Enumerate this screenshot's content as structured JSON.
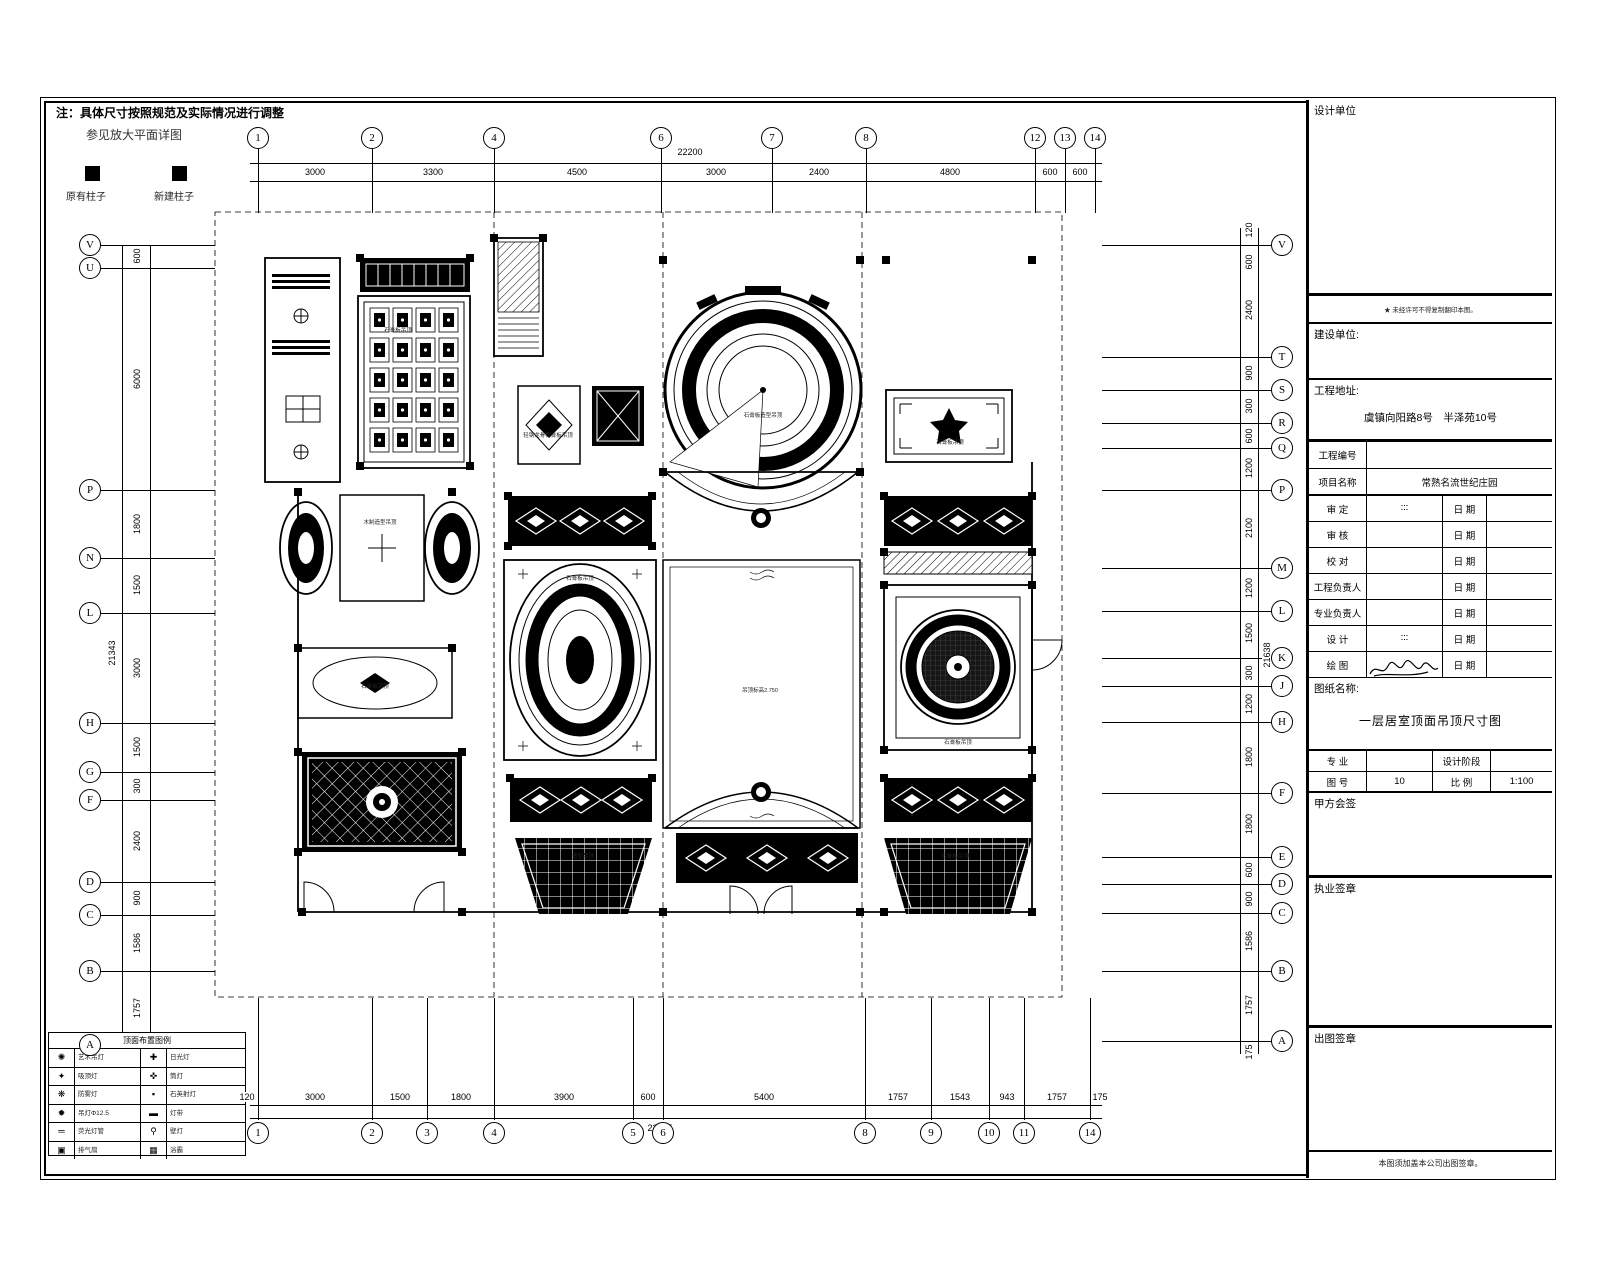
{
  "note": {
    "line1": "注：具体尺寸按照规范及实际情况进行调整",
    "line2": "参见放大平面详图",
    "existing_column": "原有柱子",
    "new_column": "新建柱子"
  },
  "axes": {
    "top": {
      "total": "22200",
      "bubbles": [
        {
          "label": "1",
          "x": 258
        },
        {
          "label": "2",
          "x": 372
        },
        {
          "label": "4",
          "x": 494
        },
        {
          "label": "6",
          "x": 661
        },
        {
          "label": "7",
          "x": 772
        },
        {
          "label": "8",
          "x": 866
        },
        {
          "label": "12",
          "x": 1035
        },
        {
          "label": "13",
          "x": 1065
        },
        {
          "label": "14",
          "x": 1095
        }
      ],
      "segments": [
        {
          "label": "3000",
          "x": 315
        },
        {
          "label": "3300",
          "x": 433
        },
        {
          "label": "4500",
          "x": 577
        },
        {
          "label": "3000",
          "x": 716
        },
        {
          "label": "2400",
          "x": 819
        },
        {
          "label": "4800",
          "x": 950
        },
        {
          "label": "600",
          "x": 1050
        },
        {
          "label": "600",
          "x": 1080
        }
      ]
    },
    "bottom": {
      "total": "22195",
      "bubbles": [
        {
          "label": "1",
          "x": 258
        },
        {
          "label": "2",
          "x": 372
        },
        {
          "label": "3",
          "x": 427
        },
        {
          "label": "4",
          "x": 494
        },
        {
          "label": "5",
          "x": 633
        },
        {
          "label": "6",
          "x": 663
        },
        {
          "label": "8",
          "x": 865
        },
        {
          "label": "9",
          "x": 931
        },
        {
          "label": "10",
          "x": 989
        },
        {
          "label": "11",
          "x": 1024
        },
        {
          "label": "14",
          "x": 1090
        }
      ],
      "segments": [
        {
          "label": "120",
          "x": 247
        },
        {
          "label": "3000",
          "x": 315
        },
        {
          "label": "1500",
          "x": 400
        },
        {
          "label": "1800",
          "x": 461
        },
        {
          "label": "3900",
          "x": 564
        },
        {
          "label": "600",
          "x": 648
        },
        {
          "label": "5400",
          "x": 764
        },
        {
          "label": "1757",
          "x": 898
        },
        {
          "label": "1543",
          "x": 960
        },
        {
          "label": "943",
          "x": 1007
        },
        {
          "label": "1757",
          "x": 1057
        },
        {
          "label": "175",
          "x": 1100
        }
      ]
    },
    "left": {
      "total": "21343",
      "bubbles": [
        {
          "label": "V",
          "y": 245
        },
        {
          "label": "U",
          "y": 268
        },
        {
          "label": "P",
          "y": 490
        },
        {
          "label": "N",
          "y": 558
        },
        {
          "label": "L",
          "y": 613
        },
        {
          "label": "H",
          "y": 723
        },
        {
          "label": "G",
          "y": 772
        },
        {
          "label": "F",
          "y": 800
        },
        {
          "label": "D",
          "y": 882
        },
        {
          "label": "C",
          "y": 915
        },
        {
          "label": "B",
          "y": 971
        },
        {
          "label": "A",
          "y": 1045
        }
      ],
      "segments": [
        {
          "label": "600",
          "y": 256
        },
        {
          "label": "6000",
          "y": 379
        },
        {
          "label": "1800",
          "y": 524
        },
        {
          "label": "1500",
          "y": 585
        },
        {
          "label": "3000",
          "y": 668
        },
        {
          "label": "1500",
          "y": 747
        },
        {
          "label": "300",
          "y": 786
        },
        {
          "label": "2400",
          "y": 841
        },
        {
          "label": "900",
          "y": 898
        },
        {
          "label": "1586",
          "y": 943
        },
        {
          "label": "1757",
          "y": 1008
        }
      ]
    },
    "right": {
      "total": "21638",
      "bubbles": [
        {
          "label": "V",
          "y": 245
        },
        {
          "label": "T",
          "y": 357
        },
        {
          "label": "S",
          "y": 390
        },
        {
          "label": "R",
          "y": 423
        },
        {
          "label": "Q",
          "y": 448
        },
        {
          "label": "P",
          "y": 490
        },
        {
          "label": "M",
          "y": 568
        },
        {
          "label": "L",
          "y": 611
        },
        {
          "label": "K",
          "y": 658
        },
        {
          "label": "J",
          "y": 686
        },
        {
          "label": "H",
          "y": 722
        },
        {
          "label": "F",
          "y": 793
        },
        {
          "label": "E",
          "y": 857
        },
        {
          "label": "D",
          "y": 884
        },
        {
          "label": "C",
          "y": 913
        },
        {
          "label": "B",
          "y": 971
        },
        {
          "label": "A",
          "y": 1041
        }
      ],
      "segments": [
        {
          "label": "120",
          "y": 230
        },
        {
          "label": "600",
          "y": 262
        },
        {
          "label": "2400",
          "y": 310
        },
        {
          "label": "900",
          "y": 373
        },
        {
          "label": "300",
          "y": 406
        },
        {
          "label": "600",
          "y": 436
        },
        {
          "label": "1200",
          "y": 468
        },
        {
          "label": "2100",
          "y": 528
        },
        {
          "label": "1200",
          "y": 588
        },
        {
          "label": "1500",
          "y": 633
        },
        {
          "label": "300",
          "y": 673
        },
        {
          "label": "1200",
          "y": 704
        },
        {
          "label": "1800",
          "y": 757
        },
        {
          "label": "1800",
          "y": 824
        },
        {
          "label": "600",
          "y": 870
        },
        {
          "label": "900",
          "y": 899
        },
        {
          "label": "1586",
          "y": 941
        },
        {
          "label": "1757",
          "y": 1005
        },
        {
          "label": "175",
          "y": 1052
        }
      ]
    }
  },
  "plan": {
    "labels": [
      {
        "text": "石膏板吊顶",
        "x": 398,
        "y": 330
      },
      {
        "text": "轻钢龙骨石膏板吊顶",
        "x": 548,
        "y": 435
      },
      {
        "text": "石膏板造型吊顶",
        "x": 763,
        "y": 415
      },
      {
        "text": "石膏板吊顶",
        "x": 950,
        "y": 442
      },
      {
        "text": "木制造型吊顶",
        "x": 380,
        "y": 522
      },
      {
        "text": "石膏板吊顶",
        "x": 580,
        "y": 578
      },
      {
        "text": "吊顶标高2.750",
        "x": 760,
        "y": 690
      },
      {
        "text": "石膏板吊顶",
        "x": 958,
        "y": 742
      },
      {
        "text": "石膏板吊顶",
        "x": 375,
        "y": 686
      },
      {
        "text": "造型吊顶",
        "x": 583,
        "y": 856
      },
      {
        "text": "石膏板吊顶",
        "x": 955,
        "y": 856
      }
    ]
  },
  "legend": {
    "title": "顶面布置图例",
    "rows": [
      {
        "icon1": "✺",
        "label1": "艺术吊灯",
        "icon2": "✚",
        "label2": "日光灯"
      },
      {
        "icon1": "✦",
        "label1": "吸顶灯",
        "icon2": "✜",
        "label2": "筒灯"
      },
      {
        "icon1": "❋",
        "label1": "防雾灯",
        "icon2": "▪",
        "label2": "石英射灯"
      },
      {
        "icon1": "✹",
        "label1": "吊灯Φ12.5",
        "icon2": "▬",
        "label2": "灯带"
      },
      {
        "icon1": "═",
        "label1": "荧光灯管",
        "icon2": "⚲",
        "label2": "壁灯"
      },
      {
        "icon1": "▣",
        "label1": "排气扇",
        "icon2": "▦",
        "label2": "浴霸"
      }
    ]
  },
  "titleblock": {
    "design_unit_label": "设计单位",
    "stamp_note": "★ 未经许可不得复制翻印本图。",
    "build_unit_label": "建设单位:",
    "address_label": "工程地址:",
    "address_value": "虞镇向阳路8号　半泽苑10号",
    "project_no_label": "工程编号",
    "project_no_value": "",
    "project_name_label": "项目名称",
    "project_name_value": "常熟名流世纪庄园",
    "date_label": "日 期",
    "sign_rows": [
      {
        "label": "审 定",
        "value": "∶∶∶"
      },
      {
        "label": "审 核",
        "value": ""
      },
      {
        "label": "校 对",
        "value": ""
      },
      {
        "label": "工程负责人",
        "value": ""
      },
      {
        "label": "专业负责人",
        "value": ""
      },
      {
        "label": "设 计",
        "value": "∶∶∶"
      },
      {
        "label": "绘 图",
        "value": ""
      }
    ],
    "sheet_name_label": "图纸名称:",
    "sheet_name_value": "一层居室顶面吊顶尺寸图",
    "major_label": "专 业",
    "major_value": "",
    "stage_label": "设计阶段",
    "stage_value": "",
    "fig_no_label": "图 号",
    "fig_no_value": "10",
    "scale_label": "比 例",
    "scale_value": "1:100",
    "owner_sign_label": "甲方会签",
    "license_seal_label": "执业签章",
    "issue_seal_label": "出图签章",
    "bottom_note": "本图须加盖本公司出图签章。"
  }
}
